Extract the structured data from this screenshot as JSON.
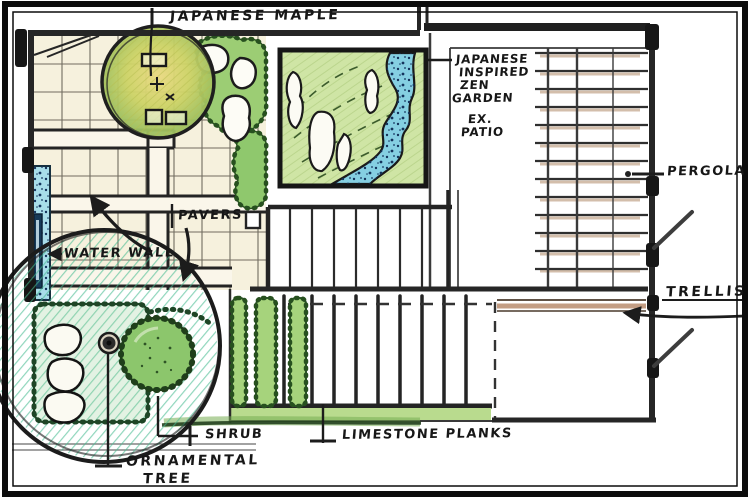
{
  "drawing_title": "Japanese inspired garden plan sketch",
  "labels": {
    "japanese_maple": "JAPANESE MAPLE",
    "zen_line1": "JAPANESE",
    "zen_line2": "INSPIRED",
    "zen_line3": "ZEN",
    "zen_line4": "GARDEN",
    "ex_patio_line1": "EX.",
    "ex_patio_line2": "PATIO",
    "pergola": "PERGOLA",
    "trellis": "TRELLIS",
    "pavers": "PAVERS",
    "water_wall": "WATER WALL",
    "shrub": "SHRUB",
    "limestone_planks": "LIMESTONE PLANKS",
    "ornamental_line1": "ORNAMENTAL",
    "ornamental_line2": "TREE"
  },
  "colors": {
    "ink": "#1c1c1c",
    "paper": "#ffffff",
    "paver_fill": "#f6f1dd",
    "canopy_yellow": "#ead982",
    "canopy_green": "#9ec05f",
    "shrub_green": "#9ccd74",
    "zen_bed_green": "#cfe5a5",
    "water_blue": "#85cfe2",
    "speckle_navy": "#14335c",
    "tree_hatch_teal": "#45bb90",
    "pergola_brown": "#b08968",
    "trellis_brown": "#b98d6e"
  }
}
